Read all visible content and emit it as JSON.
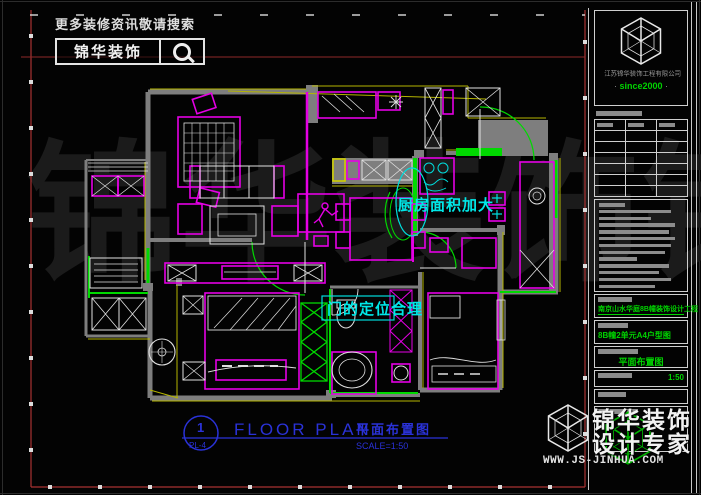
{
  "colors": {
    "magenta": "#e400e4",
    "green": "#00d900",
    "cyan": "#00dcdc",
    "yellow": "#b5b500",
    "blue": "#2a32d8",
    "frame_red": "#a83232",
    "wall_gray": "#7e7e7e"
  },
  "search": {
    "hint": "更多装修资讯敬请搜索",
    "brand": "锦华装饰"
  },
  "watermark": {
    "text": "锦华装饰锦"
  },
  "plan": {
    "kitchen_note": "厨房面积加大",
    "door_note": "门的定位合理"
  },
  "title_block": {
    "number": "1",
    "sheet": "PL-4",
    "title_en": "FLOOR PLAN",
    "title_cn": "平面布置图",
    "scale": "SCALE=1:50"
  },
  "panel": {
    "company": "江苏锦华装饰工程有限公司",
    "since": "since2000",
    "dot": "·",
    "fields": {
      "project": "南京山水华庭8B幢装饰设计工程",
      "unit": "8B幢2单元A4户型图",
      "drawing": "平面布置图",
      "scale": "1:50"
    }
  },
  "footer": {
    "brand_line1": "锦华装饰",
    "brand_line2": "设计专家",
    "url": "WWW.JS-JINHUA.COM"
  }
}
